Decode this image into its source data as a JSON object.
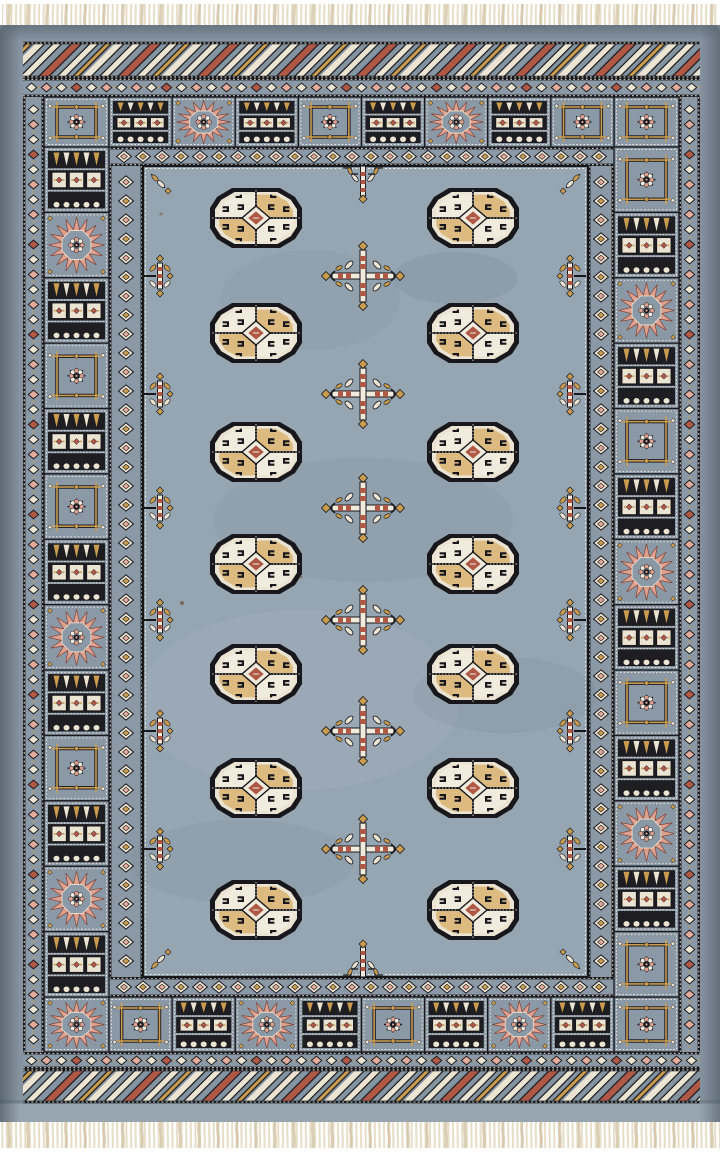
{
  "scene": {
    "description": "Product photograph of a hand-knotted Bokhara-style wool area rug on a white background. Blue-grey field with two columns of seven octagonal elephant-foot gul medallions, six chemche diamond motifs down the centre, candelabra pendants along the field edges, multiple geometric borders and ivory fringe at top and bottom.",
    "background_color": "#ffffff"
  },
  "palette": {
    "field": "#95a5b1",
    "field_dark": "#7f909c",
    "margin": "#8693a0",
    "margin_dark": "#5d6c78",
    "margin_light": "#97a5b0",
    "border_ground": "#8b99a6",
    "zig_ground": "#8494a1",
    "panel_dark": "#1d1d22",
    "black": "#17171c",
    "cream": "#ece4d2",
    "ivory": "#f1ebdd",
    "tan": "#dcba80",
    "gold": "#c99c50",
    "pink": "#e2ab9b",
    "pink_deep": "#dfa18f",
    "red": "#b05846",
    "fringe": "#e7ddc6",
    "fringe_dark": "#d3c5a8"
  },
  "rug": {
    "gul_grid": {
      "columns": 2,
      "rows": 7
    },
    "gul_column_centers": [
      256,
      473
    ],
    "gul_row_centers": [
      218,
      333,
      452,
      564,
      674,
      788,
      910
    ],
    "center_diamond_x": 363,
    "center_diamond_ys": [
      276,
      394,
      508,
      620,
      731,
      849
    ],
    "edge_pendant_x": [
      160,
      570
    ],
    "edge_pendant_ys": [
      276,
      394,
      508,
      620,
      731,
      849
    ],
    "has_top_pendant": true,
    "has_bottom_pendant": true,
    "border_layers": [
      "ivory fringe",
      "plain blue-grey outer margin",
      "diagonal zigzag end border on top and bottom",
      "small diamond guard stripe",
      "main border of alternating sunburst, snowflake and banded panels",
      "large diamond inner guard stripe",
      "open blue-grey field"
    ],
    "main_border": {
      "top_panels": [
        "band",
        "sun",
        "band",
        "snow",
        "band",
        "sun",
        "band",
        "snow"
      ],
      "bottom_panels": [
        "snow",
        "band",
        "sun",
        "band",
        "snow",
        "band",
        "sun",
        "band"
      ],
      "left_panels": [
        "band",
        "sun",
        "band",
        "snow",
        "band",
        "snow",
        "band",
        "sun",
        "band",
        "snow",
        "band",
        "sun",
        "band"
      ],
      "right_panels": [
        "snow",
        "band",
        "sun",
        "band",
        "snow",
        "band",
        "sun",
        "band",
        "snow",
        "band",
        "sun",
        "band",
        "snow"
      ],
      "corners": {
        "tl": "snow",
        "tr": "snow",
        "bl": "sun",
        "br": "snow"
      }
    }
  }
}
